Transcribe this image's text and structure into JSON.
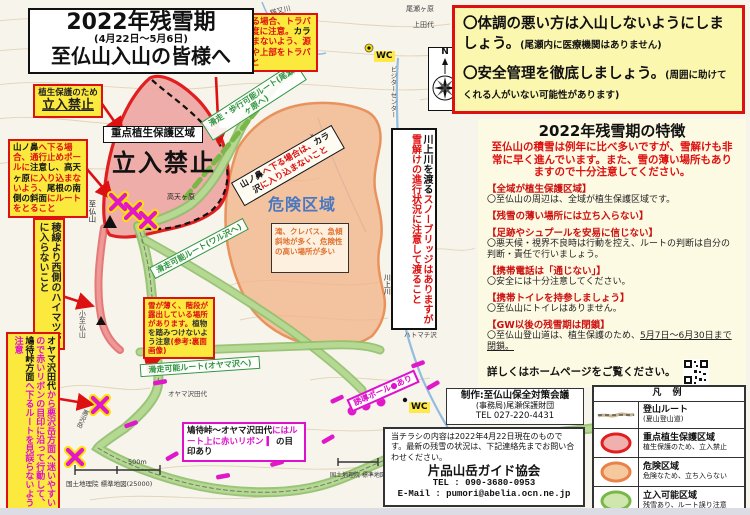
{
  "palette": {
    "red": "#dd1111",
    "magenta": "#dd11cc",
    "annotation_yellow": "#fce93e",
    "zone_pink": "#eda09e",
    "zone_orange": "#f2b488",
    "route_green": "#9cc878",
    "danger_blue": "#4a78c0",
    "panel_yellow": "#fcf7ae",
    "panel_cream": "#fdfae3"
  },
  "title": {
    "line1": "2022年残雪期",
    "line2": "(4月22日〜5月6日)",
    "line3": "至仏山入山の皆様へ"
  },
  "warnings": {
    "item1": "〇体調の悪い方は入山しないようにしましょう。",
    "item1_note": "(尾瀬内に医療機関はありません)",
    "item2": "〇安全管理を徹底しましょう。",
    "item2_note": "(周囲に助けてくれる人がいない可能性があります)"
  },
  "features": {
    "title": "2022年残雪期の特徴",
    "intro": "至仏山の積雪は例年に比べ多いですが、雪解けも非常に早く進んでいます。また、雪の薄い場所もありますので十分注意してください。",
    "items": [
      {
        "head": "【全域が植生保護区域】",
        "body": "〇至仏山の周辺は、全域が植生保護区域です。"
      },
      {
        "head": "【残雪の薄い場所には立ち入らない】",
        "body": ""
      },
      {
        "head": "【足跡やシュプールを安易に信じない】",
        "body": "〇悪天候・視界不良時は行動を控え、ルートの判断は自分の判断・責任で行いましょう。"
      },
      {
        "head": "【携帯電話は「通じない」】",
        "body": "〇安全には十分注意してください。"
      },
      {
        "head": "【携帯トイレを持参しましょう】",
        "body": "〇至仏山にトイレはありません。"
      },
      {
        "head": "【GW以後の残雪期は閉鎖】",
        "body": "〇至仏山登山道は、植生保護のため、",
        "body_u": "5月7日〜6月30日まで閉鎖。"
      }
    ],
    "footer": "詳しくはホームページをご覧ください。"
  },
  "legend": {
    "title": "凡 例",
    "rows": [
      {
        "name": "登山ルート",
        "desc": "(夏山登山道)"
      },
      {
        "name": "重点植生保護区域",
        "desc": "植生保護のため、立入禁止"
      },
      {
        "name": "危険区域",
        "desc": "危険なため、立ち入らない"
      },
      {
        "name": "立入可能区域",
        "desc": "残雪あり、ルート誤り注意"
      }
    ]
  },
  "production": {
    "line1": "制作:至仏山保全対策会議",
    "line2": "(事務局)尾瀬保護財団",
    "line3": "TEL 027-220-4431"
  },
  "contact": {
    "body": "当チラシの内容は2022年4月22日現在のものです。最新の残雪の状況は、下記連絡先までお問い合わせください。",
    "org": "片品山岳ガイド協会",
    "tel": "TEL : 090-3680-0953",
    "email": "E-Mail : pumori@abelia.ocn.ne.jp"
  },
  "annotations": {
    "a1_line1": "植生保護のため",
    "a1_line2": "立入禁止",
    "a2": [
      {
        "t": "山ノ鼻",
        "c": "#111111"
      },
      {
        "t": "へ下る場合、",
        "c": "#dd1111"
      },
      {
        "t": "通行止めポールに",
        "c": "#dd1111"
      },
      {
        "t": "注意し、",
        "c": "#111111"
      },
      {
        "t": "高天ヶ原",
        "c": "#111111"
      },
      {
        "t": "に入り込まないよう、",
        "c": "#dd1111"
      },
      {
        "t": "尾根の南側の斜面",
        "c": "#111111"
      },
      {
        "t": "にルートをとること",
        "c": "#dd1111"
      }
    ],
    "a3": [
      {
        "t": "山ノ鼻",
        "c": "#111111"
      },
      {
        "t": "へ下る場合、トラバースする高度に注意。",
        "c": "#dd1111"
      },
      {
        "t": "カラ沢",
        "c": "#111111"
      },
      {
        "t": "に入り込まないよう、源流部よりやや上部をトラバースすること",
        "c": "#dd1111"
      }
    ],
    "a4": "稜線より西側のハイマツ帯に入らないこと",
    "a5": [
      {
        "t": "オヤマ沢田代",
        "c": "#111111"
      },
      {
        "t": "から悪沢岳方面へ迷いやすいので",
        "c": "#dd11cc"
      },
      {
        "t": "赤いリボンの目印に沿って行動して、",
        "c": "#dd11cc"
      },
      {
        "t": "鳩待峠方面",
        "c": "#111111"
      },
      {
        "t": "へ下るルートを見誤らないよう注意",
        "c": "#dd11cc"
      }
    ],
    "a6": [
      {
        "t": "雪が薄く、階段が露出している場所があります。",
        "c": "#dd1111"
      },
      {
        "t": "植物を踏みつけないよう注意",
        "c": "#333333"
      },
      {
        "t": "(参考:裏面画像)",
        "c": "#dd1111"
      }
    ],
    "a7": [
      {
        "t": "鳩待峠〜オヤマ沢田代",
        "c": "#111111"
      },
      {
        "t": "には",
        "c": "#dd11cc"
      },
      {
        "t": "ルート上に赤いリボン",
        "c": "#dd11cc"
      },
      {
        "t": " ▍ ",
        "c": "#dd11cc"
      },
      {
        "t": "の目印あり",
        "c": "#111111"
      }
    ],
    "a8": "誘導ポール●あり",
    "a9": [
      {
        "t": "川上川を渡る",
        "c": "#111111"
      },
      {
        "t": "スノーブリッジはありますが",
        "c": "#dd1111"
      },
      {
        "t": "雪解けの進行状況に注意して渡ること",
        "c": "#dd1111"
      }
    ]
  },
  "map": {
    "zone_label_box": "重点植生保護区域",
    "zone_label_big": "立入禁止",
    "danger_label": "危険区域",
    "danger_note": "滝、クレバス、急傾斜地が多く、危険性の高い場所が多い",
    "route_label_ozegahara": "滑走・歩行可能ルート(尾瀬ヶ原へ)",
    "route_label_yamanohana": [
      {
        "t": "山ノ鼻",
        "c": "#111111"
      },
      {
        "t": "へ下る場合は、",
        "c": "#dd1111"
      },
      {
        "t": "カラ沢",
        "c": "#111111"
      },
      {
        "t": "に入り込まないこと",
        "c": "#dd1111"
      }
    ],
    "route_label_warusawa": "滑走可能ルート(ワル沢へ)",
    "route_label_oyamasawa": "滑走可能ルート(オヤマ沢へ)",
    "wc": "WC",
    "compass_n": "N",
    "scale_label": "500m",
    "credit": "国土地理院 標準地図(25000)",
    "places": {
      "ozegahara": "尾瀬ヶ原",
      "kamitashiro": "上田代",
      "nekomatagawa": "猫又川",
      "yamanohana": "山ノ鼻",
      "visitor_center": "ビジターセンター",
      "takatengahara": "高天ヶ原",
      "shibutsusan": "至仏山",
      "koshibutsusan": "小至仏山",
      "karasawa": "カラ沢",
      "kawakamigawa": "川上川",
      "hatomachisawa": "ハトマチ沢",
      "oyamasawatashiro": "オヤマ沢田代",
      "warusawadake": "悪沢岳"
    }
  }
}
